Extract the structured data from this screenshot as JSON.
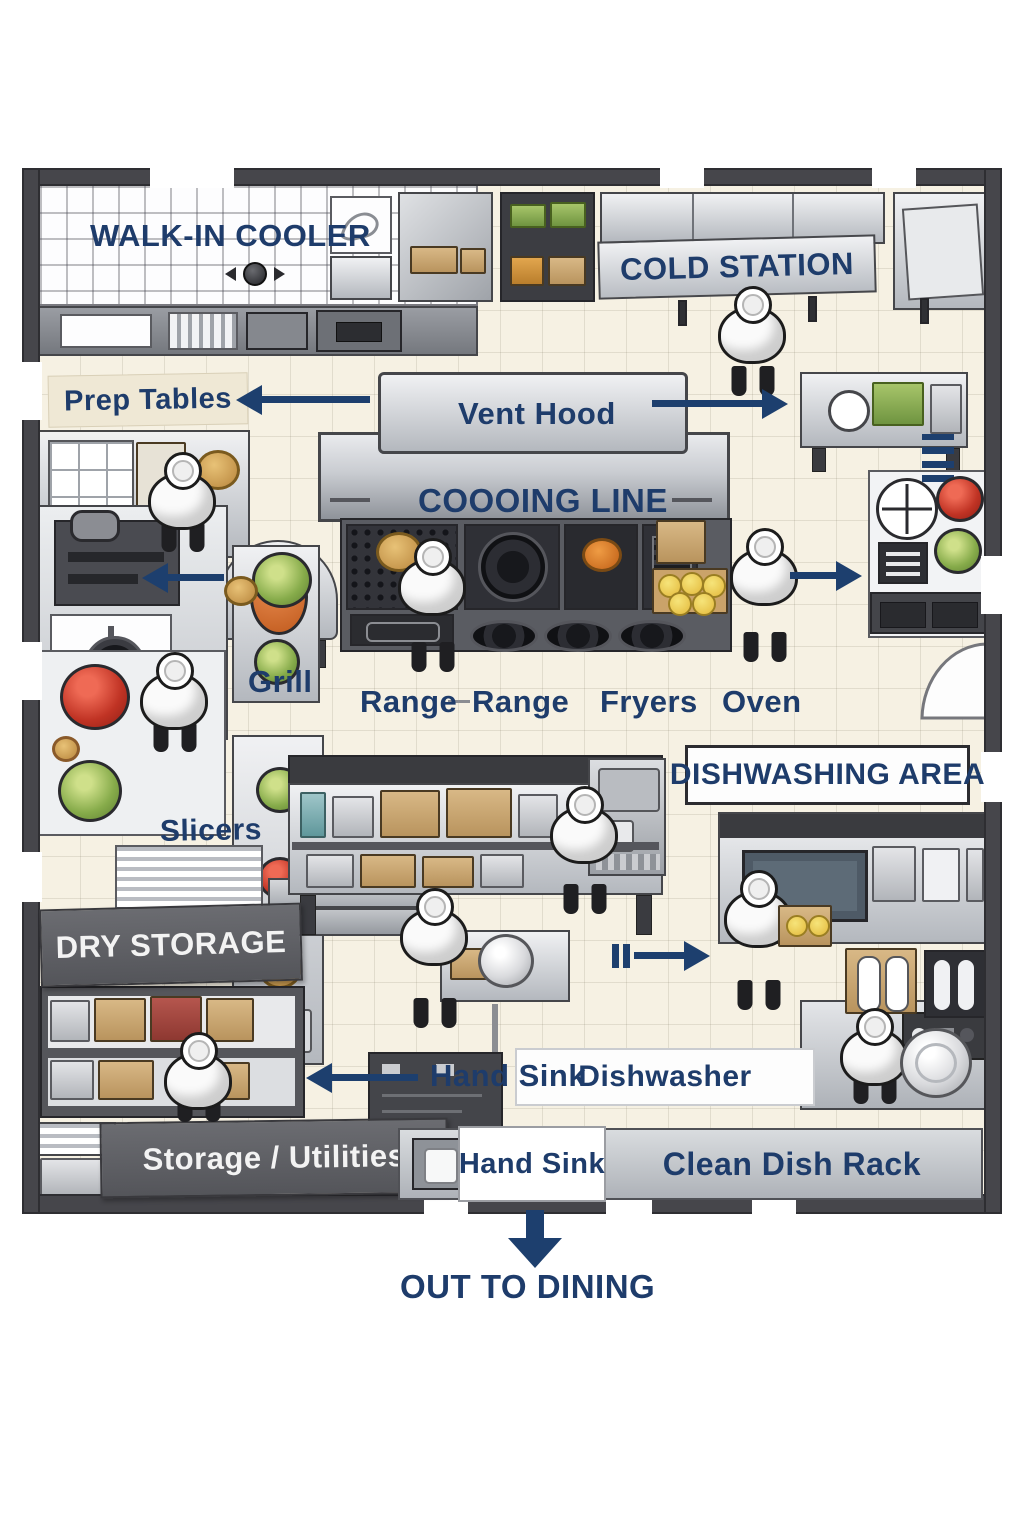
{
  "labels": {
    "walk_in_cooler": "WALK-IN COOLER",
    "prep_tables": "Prep Tables",
    "vent_hood": "Vent Hood",
    "cooking_line": "COOOING LINE",
    "cold_station": "COLD STATION",
    "grill": "Grill",
    "range_left": "Range",
    "range_right": "Range",
    "fryers": "Fryers",
    "oven": "Oven",
    "dishwashing_area": "DISHWASHING AREA",
    "slicers": "Slicers",
    "dry_storage": "DRY STORAGE",
    "hand_sink_flow": "Hand Sink",
    "dishwasher": "Dishwasher",
    "storage_utilities": "Storage / Utilities",
    "hand_sink_station": "Hand Sink",
    "clean_dish_rack": "Clean Dish Rack",
    "out_to_dining": "OUT TO DINING"
  },
  "colors": {
    "label_navy": "#1e3c6b",
    "arrow_navy": "#1d3f6e",
    "wall_gray": "#46464b",
    "floor_cream": "#f6f1e3",
    "banner_dark_gray": "#5c5d62",
    "banner_text_white": "#f3f3f3",
    "stainless_light": "#f0f1f3",
    "stainless_dark": "#b4b8be"
  },
  "icons": {
    "door-hinge-icon": "◄●►",
    "chef-figure": "css-shape",
    "scale-icon": "css-circle-cross",
    "door-swing-icon": "svg-arc"
  }
}
